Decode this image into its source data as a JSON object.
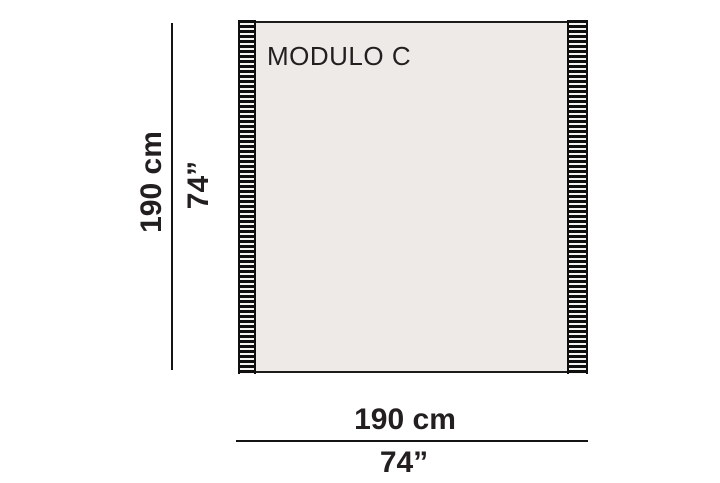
{
  "diagram": {
    "title": "MODULO C",
    "height_dim": {
      "cm": "190 cm",
      "inches": "74”"
    },
    "width_dim": {
      "cm": "190 cm",
      "inches": "74”"
    },
    "colors": {
      "background": "#ffffff",
      "panel_fill": "#eeeae7",
      "panel_border": "#1c1c1c",
      "fringe_stripe": "#0f0f0f",
      "fringe_gap": "#f6f4f1",
      "dimension_line": "#141414",
      "text": "#231f20"
    }
  }
}
